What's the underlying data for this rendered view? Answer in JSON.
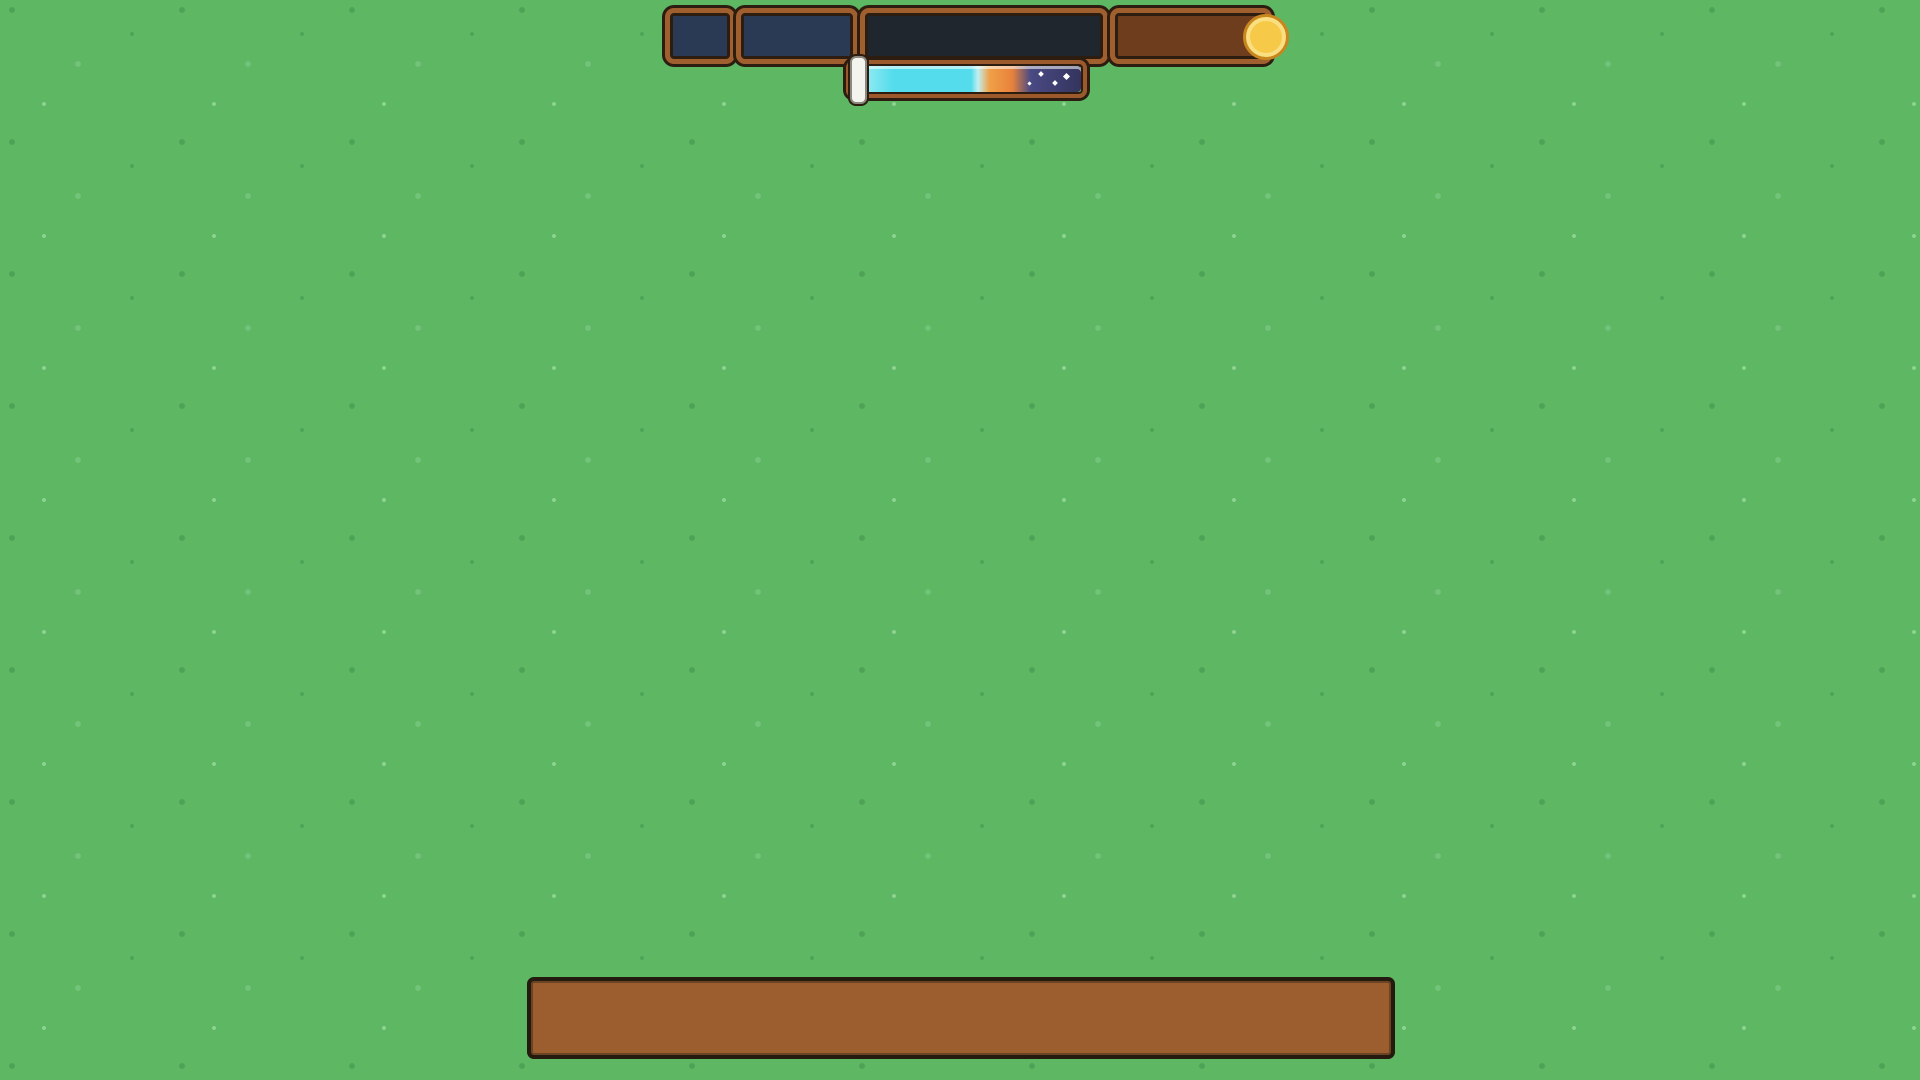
{
  "overlay": {
    "fps": "28 FPS",
    "location": "Sky"
  },
  "hud": {
    "time": "1:05pm",
    "date": "Day 22, Spring, Y2",
    "money": "4,283,009",
    "weather_icon": "sun-icon",
    "currency_icon": "coin-icon",
    "progress": {
      "marker_pct": 34,
      "start_icon": "sun-icon",
      "end_icon": "moon-icon"
    }
  },
  "hotbar": {
    "selected_index": 1,
    "slots": [
      {
        "item": "axe"
      },
      {
        "item": "pickaxe"
      },
      {
        "item": "bug-net"
      },
      {
        "item": "fishing-rod"
      },
      {
        "item": null
      },
      {
        "item": null
      },
      {
        "item": null
      },
      {
        "item": null
      },
      {
        "item": null
      },
      {
        "item": null
      },
      {
        "item": null
      },
      {
        "item": "blue-bottle"
      }
    ]
  },
  "palette": {
    "grass": "#5eb763",
    "stone": "#dedcd4",
    "wood": "#9c5b2d",
    "wood_dark": "#6b4423",
    "glass": "#d7ebf0",
    "panel_border": "#a05f2e",
    "panel_outline": "#2c1d10",
    "panel_navy": "#2a3a55",
    "panel_black": "#20262e",
    "panel_brown": "#6e3d1e",
    "text_mint": "#bfeeda",
    "text_gold": "#f4c453",
    "select_red": "#e8472e",
    "slot_cream": "#f8ecd4",
    "day_cyan": "#54dcec",
    "sunset_orange": "#e8893c",
    "night_navy": "#3c3c6e",
    "bee_black": "#16160f",
    "bee_red": "#e23048",
    "bee_pink": "#f090a8",
    "solar_purple": "#8a3fae",
    "solar_blue": "#2e3e9e",
    "tank_soil": "#e08a32",
    "tank_water": "#5aa8e0",
    "pink_tree": "#f2a3b8",
    "teal_tree": "#4cc3c8",
    "pine_green": "#2f8f4e"
  },
  "scene": {
    "bee_yard": {
      "cols": 5,
      "bands": [
        {
          "top_swarms": [
            "black",
            "black",
            "black",
            "black",
            "black"
          ],
          "mid_swarms": [
            "red",
            "red",
            "red",
            "black",
            "black"
          ]
        },
        {
          "top_swarms": [
            "ladybug",
            "ladybug",
            "ladybug",
            "ladybug",
            "ladybug"
          ],
          "mid_swarms": [
            "pink",
            "pink",
            "pink",
            "pink",
            "pink"
          ]
        },
        {
          "top_swarms": [
            "ladybug",
            "ladybug",
            "ladybug",
            "ladybug",
            "ladybug"
          ],
          "mid_swarms": [
            "pink",
            "pink",
            "pink",
            "pink",
            "pink"
          ]
        }
      ]
    },
    "worm_boxes": 6,
    "extractors": [
      "gold",
      "gold",
      "gold",
      "melon",
      "melon",
      "melon"
    ],
    "left_solar_panels": 4,
    "press_column": {
      "presses": 4,
      "baskets": 4
    },
    "right_generators": 5,
    "aquariums": [
      {
        "critters": [
          "blue-fish",
          "brown-critter"
        ]
      },
      {
        "critters": [
          "snail"
        ]
      },
      {
        "critters": [
          "pink-fish",
          "black-fish"
        ]
      },
      {
        "critters": [
          "blue-fish",
          "black-fish"
        ]
      }
    ],
    "top_tanks": [
      {
        "critters": [
          "snail"
        ]
      },
      {
        "critters": [
          "ladybug"
        ]
      },
      {
        "critters": [
          "beetle"
        ]
      },
      {
        "critters": [
          "beetle",
          "dragonfly-teal",
          "dragonfly-purple"
        ]
      },
      {
        "critters": [
          "butterfly",
          "butterfly"
        ]
      }
    ],
    "player": {
      "hat": "duck",
      "tool": "pickaxe",
      "pet": "cat"
    }
  }
}
